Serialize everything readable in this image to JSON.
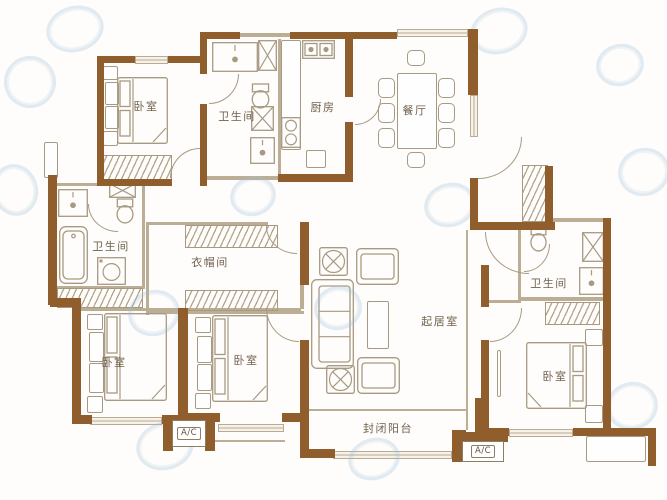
{
  "plan": {
    "kind": "apartment-floor-plan"
  },
  "rooms": {
    "bedroom_top_left": {
      "label": "卧室"
    },
    "bathroom_top": {
      "label": "卫生间"
    },
    "kitchen": {
      "label": "厨房"
    },
    "dining_room": {
      "label": "餐厅"
    },
    "bathroom_left": {
      "label": "卫生间"
    },
    "cloakroom": {
      "label": "衣帽间"
    },
    "living_room": {
      "label": "起居室"
    },
    "bathroom_right": {
      "label": "卫生间"
    },
    "bedroom_bottom_left": {
      "label": "卧室"
    },
    "bedroom_bottom_middle": {
      "label": "卧室"
    },
    "bedroom_bottom_right": {
      "label": "卧室"
    },
    "enclosed_balcony": {
      "label": "封闭阳台"
    }
  },
  "ac_platforms": {
    "left": {
      "label": "A/C"
    },
    "right": {
      "label": "A/C"
    }
  },
  "colors": {
    "wall": "#8f5e2c",
    "thin_wall": "#bcae94",
    "furniture_line": "#a79a82",
    "label_text": "#70614e",
    "watermark": "#9ebedb",
    "background": "#fefdfb"
  }
}
